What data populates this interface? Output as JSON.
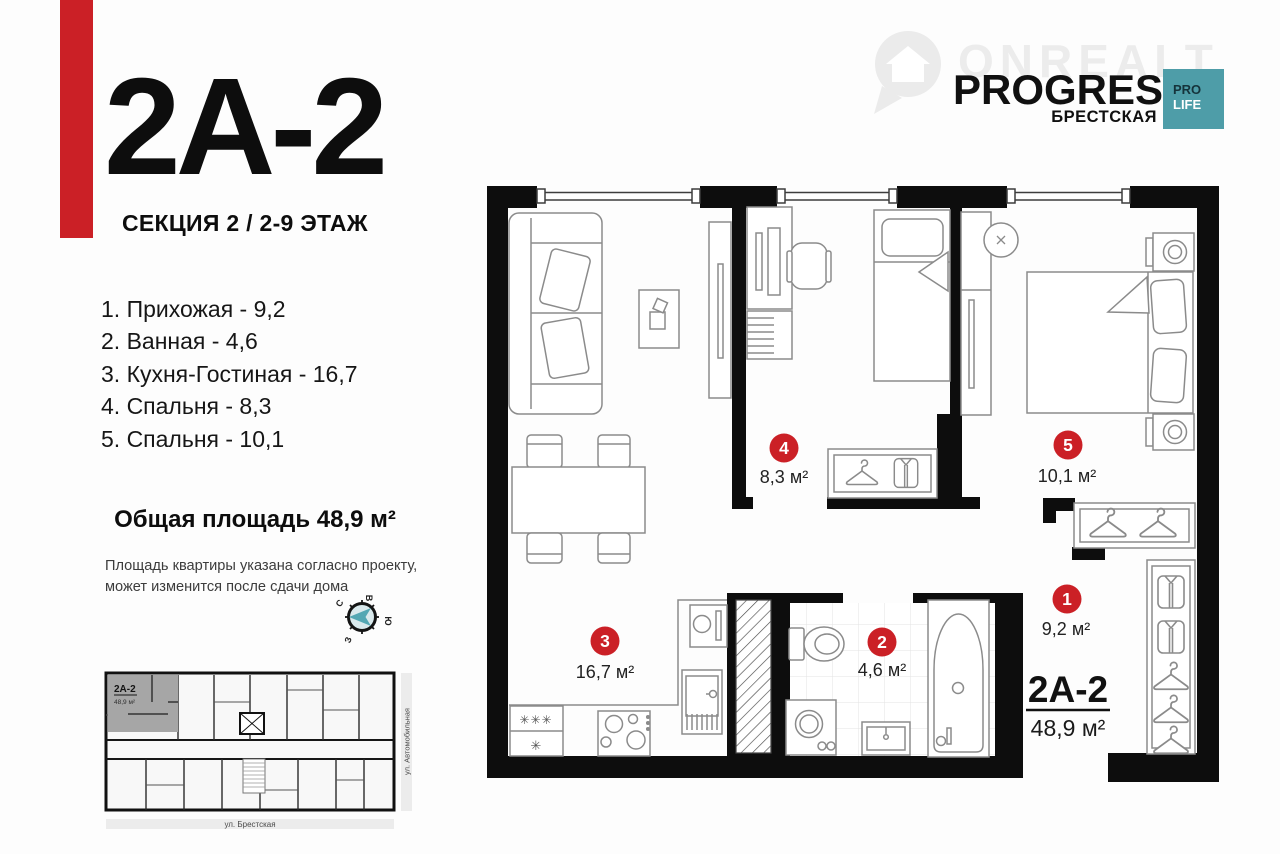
{
  "colors": {
    "accent_red": "#cb2026",
    "teal": "#4e9da8"
  },
  "left_panel": {
    "apartment_code": "2A-2",
    "section_line": "СЕКЦИЯ 2 / 2-9 ЭТАЖ",
    "room_list": [
      "1. Прихожая - 9,2",
      "2. Ванная - 4,6",
      "3. Кухня-Гостиная - 16,7",
      "4. Спальня - 8,3",
      "5. Спальня - 10,1"
    ],
    "total_area": "Общая площадь 48,9 м²",
    "disclaimer_line1": "Площадь квартиры указана согласно проекту,",
    "disclaimer_line2": "может изменится после сдачи дома"
  },
  "compass": {
    "top": "В",
    "right": "Ю",
    "bottom": "З",
    "left": "С"
  },
  "brand": {
    "watermark": "ONREALT",
    "logo_title": "PROGRESS",
    "logo_subtitle": "БРЕСТСКАЯ",
    "badge_top": "PRO",
    "badge_bottom": "LIFE"
  },
  "floor_plan": {
    "badges": [
      {
        "num": "1",
        "area": "9,2 м²"
      },
      {
        "num": "2",
        "area": "4,6 м²"
      },
      {
        "num": "3",
        "area": "16,7 м²"
      },
      {
        "num": "4",
        "area": "8,3 м²"
      },
      {
        "num": "5",
        "area": "10,1 м²"
      }
    ],
    "unit_code": "2A-2",
    "unit_area": "48,9 м²",
    "fridge_top": "✳✳✳",
    "fridge_bottom": "✳"
  },
  "mini_plan": {
    "unit_code": "2A-2",
    "unit_area": "48,9 м²",
    "street_right": "ул. Автомобильная",
    "street_bottom": "ул. Брестская"
  }
}
